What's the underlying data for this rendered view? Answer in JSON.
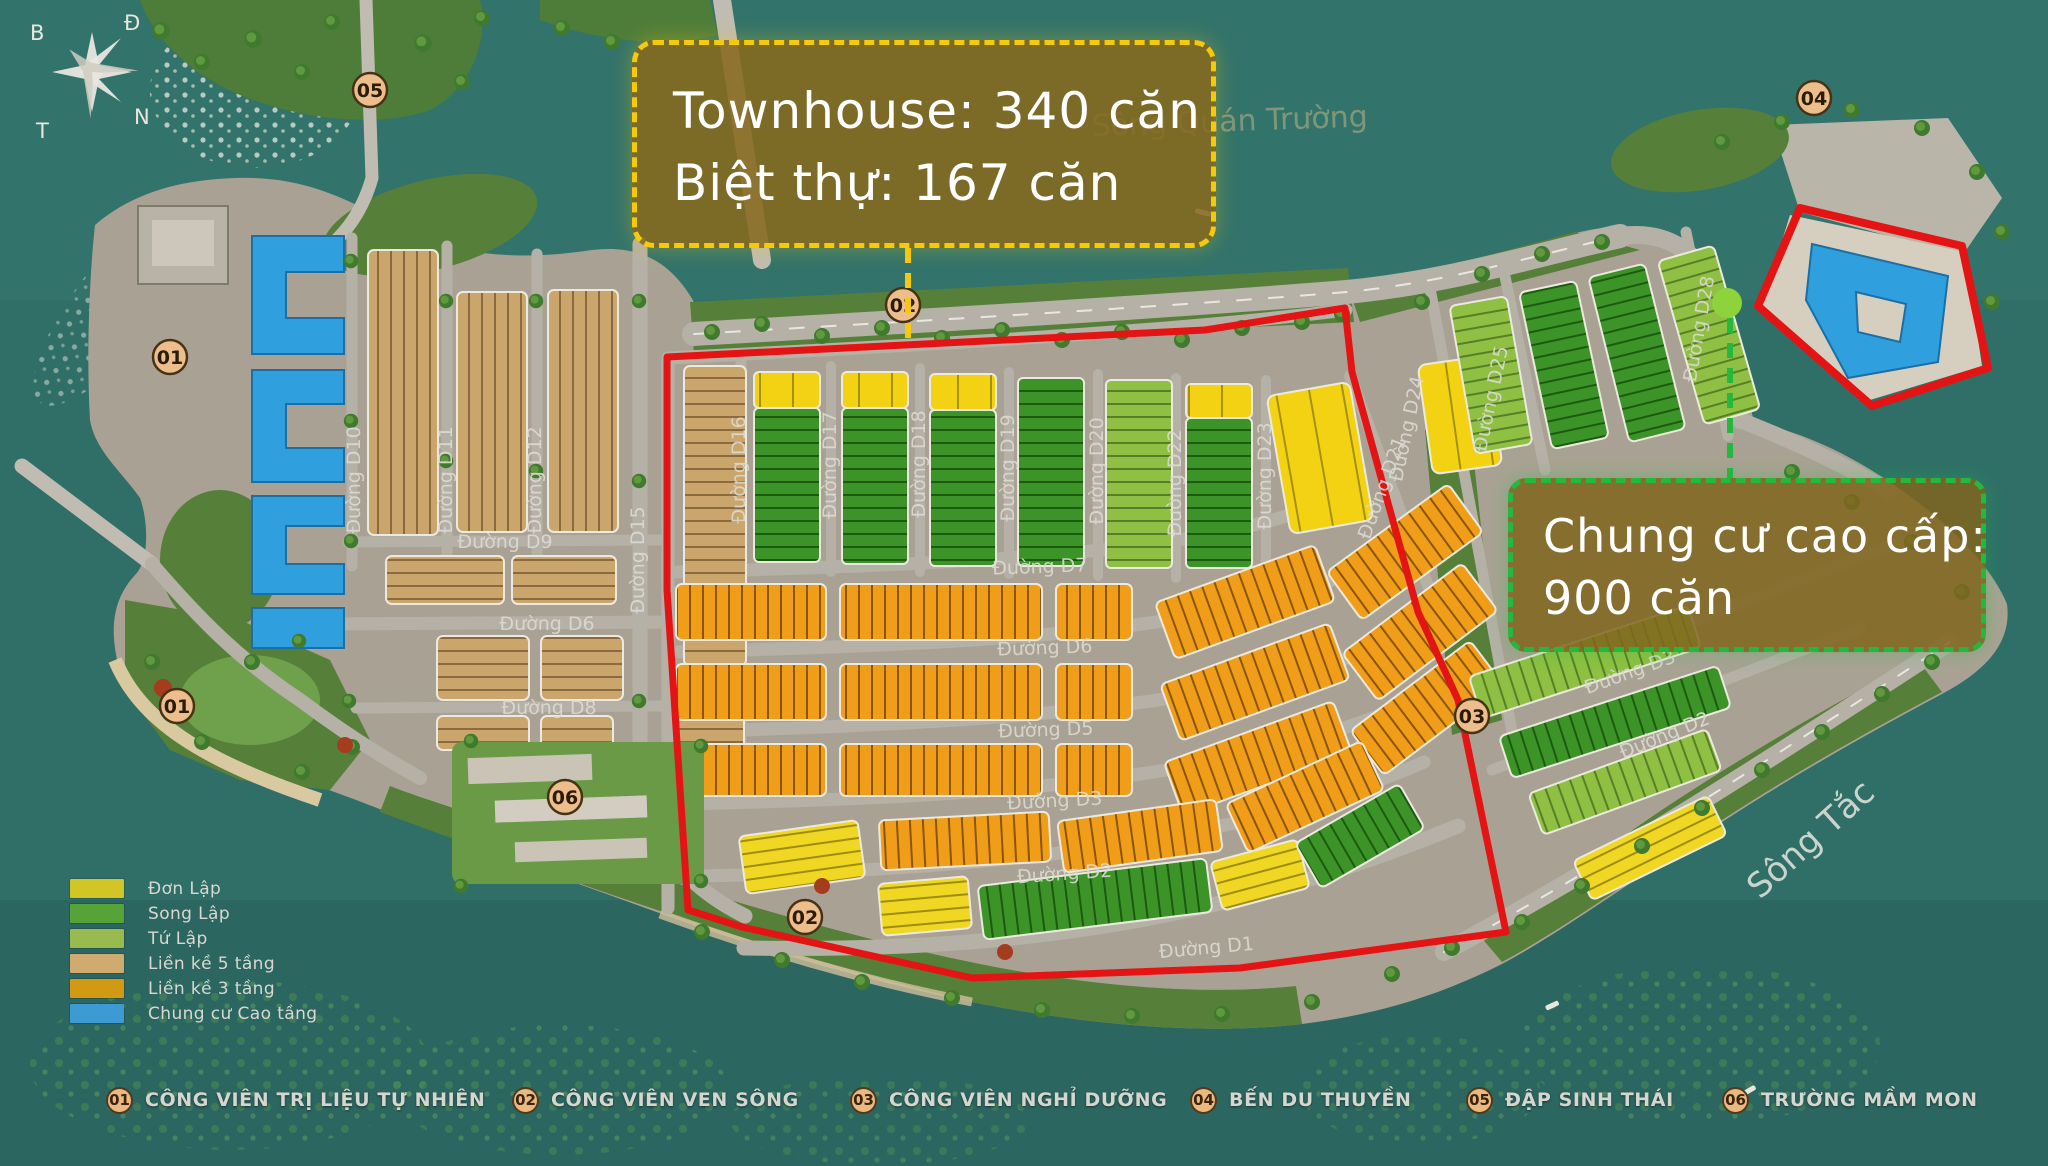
{
  "callouts": {
    "townhouse": {
      "line1": "Townhouse: 340 căn",
      "line2": "Biệt thự: 167 căn"
    },
    "apartment": {
      "line1": "Chung cư cao cấp:",
      "line2": "900 căn"
    }
  },
  "legend": {
    "items": [
      {
        "label": "Đơn Lập",
        "color": "#d2c526"
      },
      {
        "label": "Song Lập",
        "color": "#57a337"
      },
      {
        "label": "Tứ Lập",
        "color": "#97bb4e"
      },
      {
        "label": "Liền kề 5 tầng",
        "color": "#cfab70"
      },
      {
        "label": "Liền kề 3 tầng",
        "color": "#d29a12"
      },
      {
        "label": "Chung cư Cao tầng",
        "color": "#3e9ad3"
      }
    ]
  },
  "amenities": {
    "items": [
      {
        "number": "01",
        "label": "CÔNG VIÊN TRỊ LIỆU TỰ NHIÊN"
      },
      {
        "number": "02",
        "label": "CÔNG VIÊN VEN SÔNG"
      },
      {
        "number": "03",
        "label": "CÔNG VIÊN NGHỈ DƯỠNG"
      },
      {
        "number": "04",
        "label": "BẾN DU THUYỀN"
      },
      {
        "number": "05",
        "label": "ĐẬP SINH THÁI"
      },
      {
        "number": "06",
        "label": "TRƯỜNG MẦM MON"
      }
    ]
  },
  "compass": {
    "north": "B",
    "east": "Đ",
    "south": "N",
    "west": "T"
  },
  "map": {
    "markers": [
      {
        "number": "05"
      },
      {
        "number": "04"
      },
      {
        "number": "01"
      },
      {
        "number": "02"
      },
      {
        "number": "01"
      },
      {
        "number": "06"
      },
      {
        "number": "02"
      },
      {
        "number": "03"
      }
    ],
    "road_labels": [
      {
        "text": "Đường D10"
      },
      {
        "text": "Đường D11"
      },
      {
        "text": "Đường D12"
      },
      {
        "text": "Đường D15"
      },
      {
        "text": "Đường D16"
      },
      {
        "text": "Đường D9"
      },
      {
        "text": "Đường D6"
      },
      {
        "text": "Đường D8"
      },
      {
        "text": "Đường D17"
      },
      {
        "text": "Đường D18"
      },
      {
        "text": "Đường D19"
      },
      {
        "text": "Đường D20"
      },
      {
        "text": "Đường D22"
      },
      {
        "text": "Đường D23"
      },
      {
        "text": "Đường D21"
      },
      {
        "text": "Đường D7"
      },
      {
        "text": "Đường D6"
      },
      {
        "text": "Đường D5"
      },
      {
        "text": "Đường D3"
      },
      {
        "text": "Đường D2"
      },
      {
        "text": "Đường D1"
      },
      {
        "text": "Đường D24"
      },
      {
        "text": "Đường D25"
      },
      {
        "text": "Đường D28"
      },
      {
        "text": "Đường D3"
      },
      {
        "text": "Đường D2"
      }
    ],
    "river_labels": [
      {
        "text": "Sông Quán Trường"
      },
      {
        "text": "Sông Tắc"
      }
    ],
    "colors": {
      "boundary_red": "#e41414",
      "townhouse_callout_border": "#f6c90a",
      "apartment_callout_border": "#24b83e",
      "marker_background": "#edbd8c",
      "water": "#2f6f68"
    }
  }
}
